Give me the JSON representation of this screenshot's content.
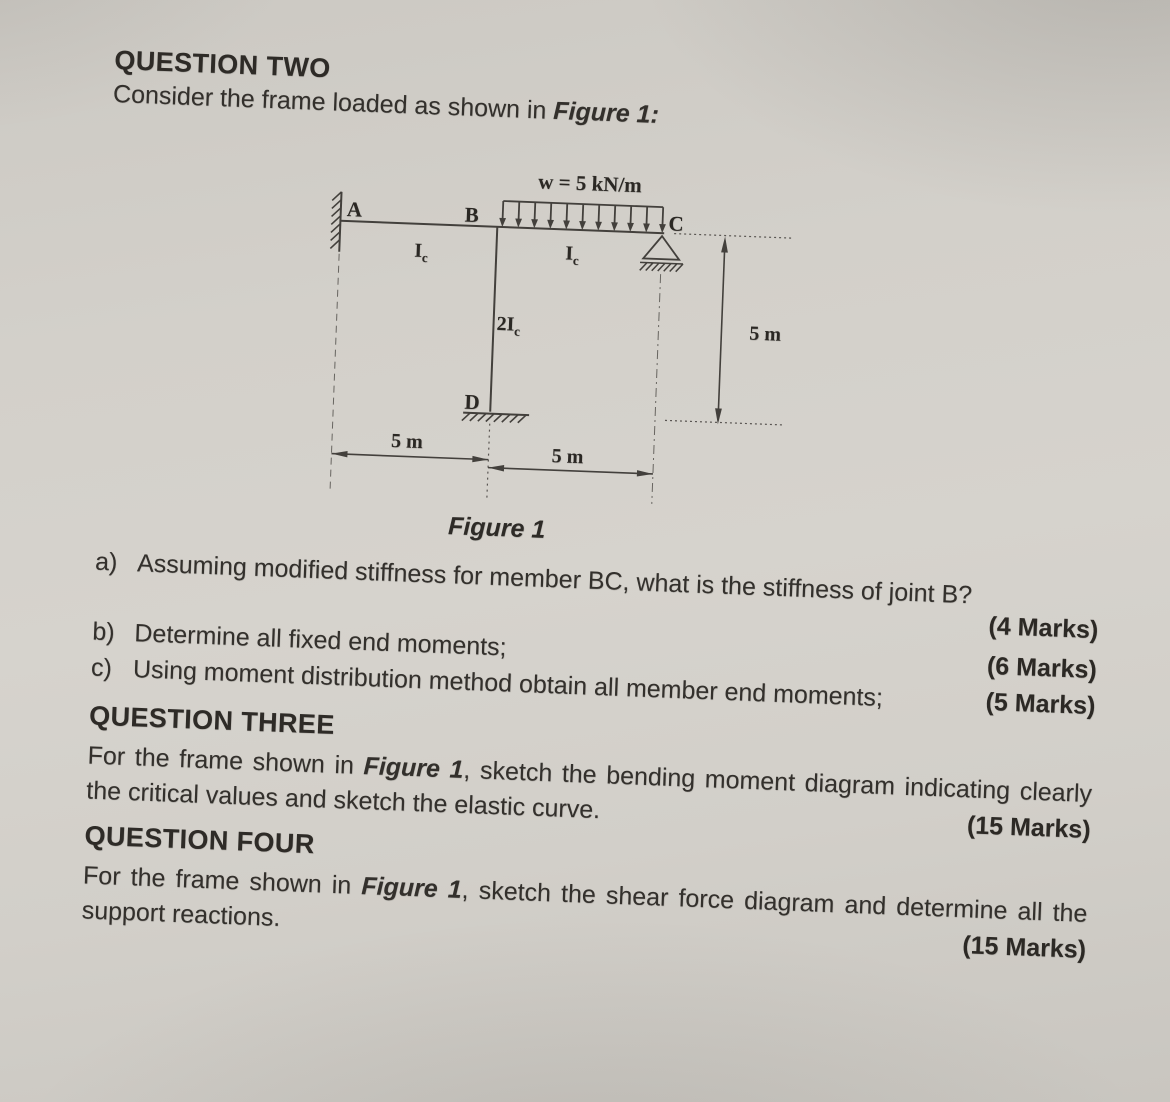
{
  "question_two": {
    "heading": "QUESTION TWO",
    "intro_before": "Consider the frame loaded as shown in ",
    "intro_ref": "Figure 1:",
    "parts": [
      {
        "label": "a)",
        "text": "Assuming modified stiffness for member BC, what is the stiffness of joint B?",
        "marks": "(4 Marks)"
      },
      {
        "label": "b)",
        "text": "Determine all fixed end moments;",
        "marks": "(6 Marks)"
      },
      {
        "label": "c)",
        "text": "Using moment distribution method obtain all member end moments;",
        "marks": "(5 Marks)"
      }
    ]
  },
  "figure": {
    "caption": "Figure 1",
    "load_label": "w = 5 kN/m",
    "nodes": {
      "a": "A",
      "b": "B",
      "c": "C",
      "d": "D"
    },
    "members": {
      "ab": {
        "base": "I",
        "sub": "c"
      },
      "bc": {
        "base": "I",
        "sub": "c"
      },
      "bd": {
        "base": "2I",
        "sub": "c"
      }
    },
    "dims": {
      "span_left": "5 m",
      "span_right": "5 m",
      "height": "5 m"
    },
    "ink_color": "#43403c"
  },
  "question_three": {
    "heading": "QUESTION THREE",
    "body_before": "For the frame shown in ",
    "body_ref": "Figure 1",
    "body_after": ", sketch the bending moment diagram indicating clearly the critical values and sketch the elastic curve.",
    "marks": "(15 Marks)"
  },
  "question_four": {
    "heading": "QUESTION FOUR",
    "body_before": "For the frame shown in ",
    "body_ref": "Figure 1",
    "body_after": ", sketch the shear force diagram and determine all the support reactions.",
    "marks": "(15 Marks)"
  }
}
